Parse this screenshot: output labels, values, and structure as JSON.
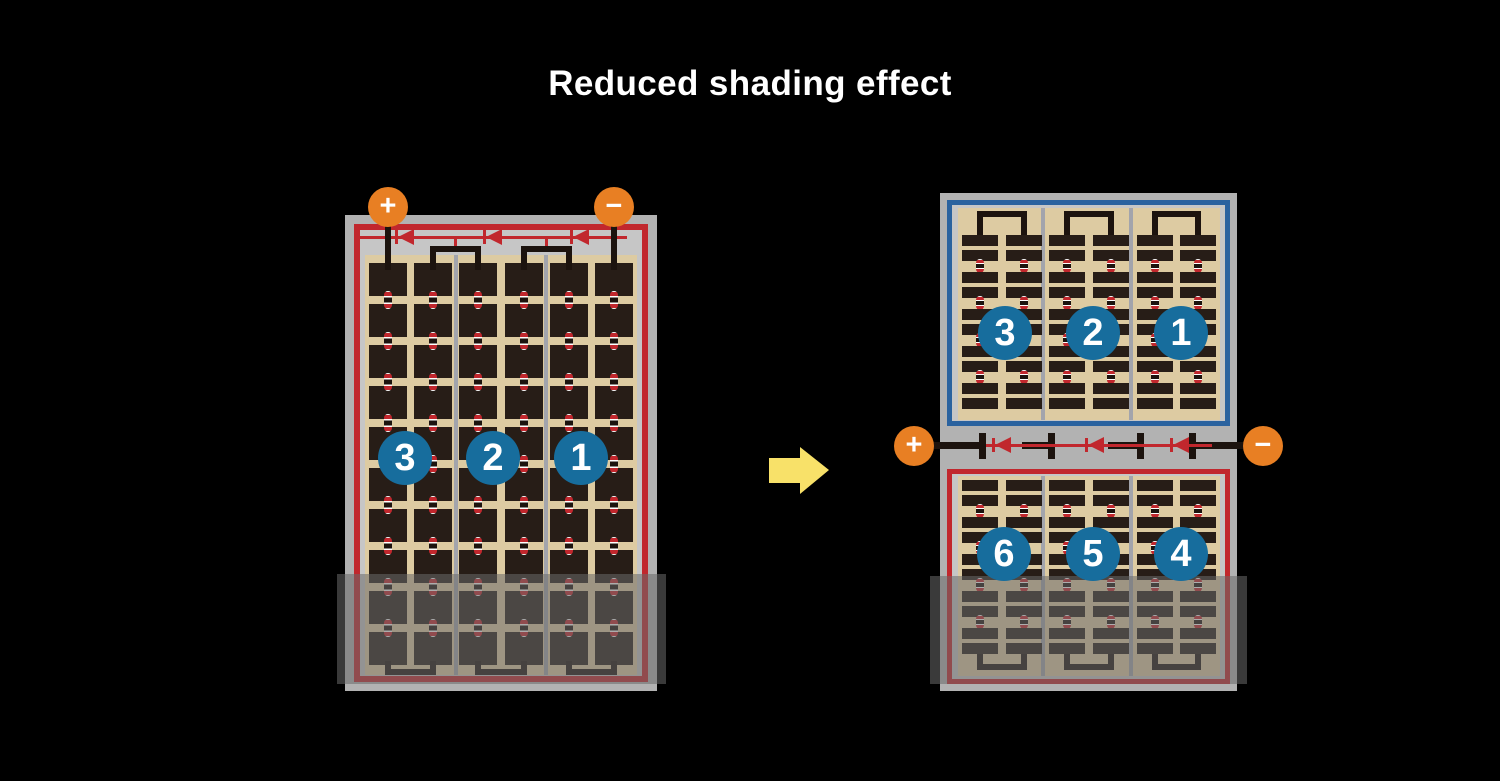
{
  "title": "Reduced shading effect",
  "colors": {
    "background": "#000000",
    "frame_gray": "#b2b2b2",
    "inner_gray": "#c6c6c6",
    "cell_field_tan": "#ddcba2",
    "cell_dark": "#271d17",
    "wire_black": "#1c130e",
    "column_separator_gray": "#a2a4ac",
    "string_border_red": "#c1272d",
    "string_border_blue": "#2a629f",
    "number_circle_blue": "#176d9d",
    "terminal_orange": "#e87f23",
    "arrow_yellow": "#f8e169",
    "shade_overlay": "rgba(105,105,105,0.55)"
  },
  "left_module": {
    "terminals": {
      "positive": "+",
      "negative": "−"
    },
    "string_numbers": [
      "3",
      "2",
      "1"
    ],
    "grid": {
      "columns": 3,
      "cells_per_column_row": 2,
      "cell_rows": 10,
      "bypass_diodes": 3
    }
  },
  "right_module": {
    "terminals": {
      "positive": "+",
      "negative": "−"
    },
    "top_half": {
      "string_numbers": [
        "3",
        "2",
        "1"
      ],
      "grid": {
        "columns": 3,
        "half_cell_pair_rows": 5
      }
    },
    "bottom_half": {
      "string_numbers": [
        "6",
        "5",
        "4"
      ],
      "grid": {
        "columns": 3,
        "half_cell_pair_rows": 5
      }
    },
    "bypass_diodes": 3
  }
}
